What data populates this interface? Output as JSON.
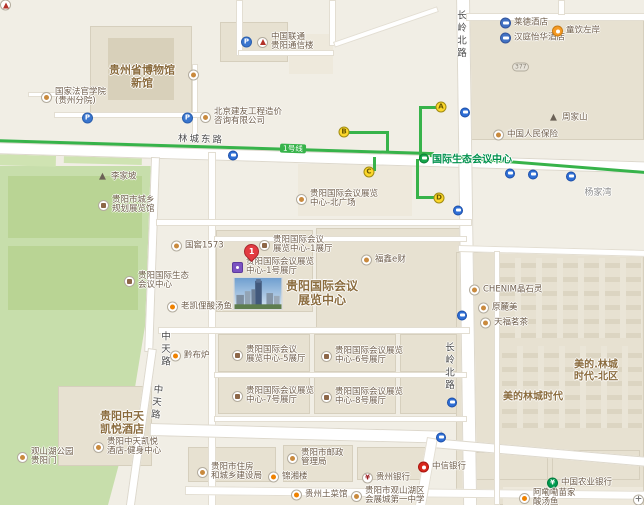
{
  "colors": {
    "metro_line": "#37b34a",
    "park_green": "#c7deab",
    "road_white": "#ffffff",
    "area_label_brown": "#8b6c3e",
    "station_green": "#00914d",
    "exit_yellow": "#fcd72b",
    "pin_red": "#e23b41"
  },
  "transit": {
    "line_label": "1号线",
    "line_label_pos": {
      "x": 280,
      "y": 144
    },
    "station": {
      "name": "国际生态会议中心",
      "x": 419,
      "y": 158
    },
    "exits": [
      {
        "label": "A",
        "x": 441,
        "y": 107
      },
      {
        "label": "B",
        "x": 344,
        "y": 132
      },
      {
        "label": "C",
        "x": 369,
        "y": 172
      },
      {
        "label": "D",
        "x": 439,
        "y": 198
      }
    ],
    "bus_stops": [
      [
        233,
        151
      ],
      [
        465,
        108
      ],
      [
        458,
        206
      ],
      [
        462,
        311
      ],
      [
        452,
        398
      ],
      [
        441,
        433
      ],
      [
        510,
        169
      ],
      [
        533,
        170
      ],
      [
        571,
        172
      ]
    ]
  },
  "road_labels": [
    {
      "text": "林城东路",
      "x": 178,
      "y": 131,
      "vertical": false,
      "rotate": 2
    },
    {
      "text": "长岭北路",
      "x": 453,
      "y": 10,
      "vertical": true,
      "rotate": 0
    },
    {
      "text": "长岭北路",
      "x": 441,
      "y": 342,
      "vertical": true,
      "rotate": 0
    },
    {
      "text": "中天路",
      "x": 157,
      "y": 331,
      "vertical": true,
      "rotate": 0
    },
    {
      "text": "中天路",
      "x": 148,
      "y": 384,
      "vertical": true,
      "rotate": 6
    }
  ],
  "area_labels": [
    {
      "id": "guizhou-museum",
      "lines": [
        "贵州省博物馆",
        "新馆"
      ],
      "x": 142,
      "y": 77,
      "size": 11,
      "muted": false
    },
    {
      "id": "exhibition-center",
      "lines": [
        "贵阳国际会议",
        "展览中心"
      ],
      "x": 322,
      "y": 294,
      "size": 12,
      "muted": false
    },
    {
      "id": "hyatt-hotel",
      "lines": [
        "贵阳中天",
        "凯悦酒店"
      ],
      "x": 122,
      "y": 423,
      "size": 11,
      "muted": false
    },
    {
      "id": "meidi-lincheng-north",
      "lines": [
        "美的.林城",
        "时代-北区"
      ],
      "x": 596,
      "y": 371,
      "size": 10,
      "muted": false
    },
    {
      "id": "meidi-lincheng",
      "lines": [
        "美的林城时代"
      ],
      "x": 533,
      "y": 397,
      "size": 10,
      "muted": false
    },
    {
      "id": "yangjiawan",
      "lines": [
        "杨家湾"
      ],
      "x": 598,
      "y": 193,
      "size": 9,
      "muted": true
    }
  ],
  "pin": {
    "label": "1",
    "x": 252,
    "y": 252
  },
  "pois": [
    {
      "id": "corner-cut",
      "icon": "redb",
      "x": 6,
      "y": 5,
      "lines": []
    },
    {
      "id": "parking-museum-west",
      "icon": "park",
      "x": 88,
      "y": 118,
      "lines": []
    },
    {
      "id": "parking-museum-east",
      "icon": "park",
      "x": 188,
      "y": 118,
      "lines": []
    },
    {
      "id": "law-college",
      "icon": "dot",
      "x": 47,
      "y": 97,
      "lines": [
        "国家法官学院",
        "(贵州分院)"
      ]
    },
    {
      "id": "museum-dot",
      "icon": "dot",
      "x": 194,
      "y": 75,
      "lines": []
    },
    {
      "id": "parking-unicom",
      "icon": "park",
      "x": 247,
      "y": 42,
      "lines": []
    },
    {
      "id": "china-unicom",
      "icon": "redb",
      "x": 263,
      "y": 42,
      "lines": [
        "中国联通",
        "贵阳通信楼"
      ]
    },
    {
      "id": "jianyou-consulting",
      "icon": "dot",
      "x": 206,
      "y": 117,
      "lines": [
        "北京建友工程造价",
        "咨询有限公司"
      ]
    },
    {
      "id": "laide-hotel",
      "icon": "hotel",
      "x": 506,
      "y": 23,
      "lines": [
        "莱德酒店"
      ]
    },
    {
      "id": "hanting-hotel",
      "icon": "hotel",
      "x": 506,
      "y": 38,
      "lines": [
        "汉庭怡华酒店"
      ]
    },
    {
      "id": "zuoan-cafe",
      "icon": "cafe",
      "x": 558,
      "y": 31,
      "lines": [
        "童饮左岸"
      ]
    },
    {
      "id": "badge-377",
      "icon": "badge",
      "x": 518,
      "y": 67,
      "badge": "377",
      "lines": []
    },
    {
      "id": "zhoujiashan",
      "icon": "mtn",
      "x": 554,
      "y": 118,
      "lines": [
        "周家山"
      ]
    },
    {
      "id": "picc",
      "icon": "dot",
      "x": 499,
      "y": 135,
      "lines": [
        "中国人民保险"
      ]
    },
    {
      "id": "lijiapo",
      "icon": "mtn",
      "x": 103,
      "y": 177,
      "lines": [
        "李家坡"
      ]
    },
    {
      "id": "planning-hall",
      "icon": "bldg",
      "x": 104,
      "y": 205,
      "lines": [
        "贵阳市城乡",
        "规划展览馆"
      ]
    },
    {
      "id": "guojiao-1573",
      "icon": "dot",
      "x": 177,
      "y": 246,
      "lines": [
        "国窖1573"
      ]
    },
    {
      "id": "eco-conference-center",
      "icon": "bldg",
      "x": 130,
      "y": 281,
      "lines": [
        "贵阳国际生态",
        "会议中心"
      ]
    },
    {
      "id": "north-plaza",
      "icon": "dot",
      "x": 302,
      "y": 199,
      "lines": [
        "贵阳国际会议展览",
        "中心-北广场"
      ]
    },
    {
      "id": "hall-1",
      "icon": "bldg",
      "x": 265,
      "y": 245,
      "lines": [
        "贵阳国际会议",
        "展览中心-1展厅"
      ]
    },
    {
      "id": "hall-1hao",
      "icon": "purple",
      "x": 238,
      "y": 267,
      "lines": [
        "贵阳国际会议展览",
        "中心-1号展厅"
      ]
    },
    {
      "id": "fuxin-ecai",
      "icon": "dot",
      "x": 367,
      "y": 260,
      "lines": [
        "福鑫e财"
      ]
    },
    {
      "id": "laokaili-fish",
      "icon": "rest",
      "x": 173,
      "y": 307,
      "lines": [
        "老凯俚酸汤鱼"
      ]
    },
    {
      "id": "qianbulu",
      "icon": "rest",
      "x": 176,
      "y": 356,
      "lines": [
        "黔布炉"
      ]
    },
    {
      "id": "hall-5",
      "icon": "bldg",
      "x": 238,
      "y": 355,
      "lines": [
        "贵阳国际会议",
        "展览中心-5展厅"
      ]
    },
    {
      "id": "hall-6",
      "icon": "bldg",
      "x": 327,
      "y": 356,
      "lines": [
        "贵阳国际会议展览",
        "中心-6号展厅"
      ]
    },
    {
      "id": "hall-7",
      "icon": "bldg",
      "x": 238,
      "y": 396,
      "lines": [
        "贵阳国际会议展览",
        "中心-7号展厅"
      ]
    },
    {
      "id": "hall-8",
      "icon": "bldg",
      "x": 327,
      "y": 397,
      "lines": [
        "贵阳国际会议展览",
        "中心-8号展厅"
      ]
    },
    {
      "id": "chenim",
      "icon": "dot",
      "x": 475,
      "y": 290,
      "lines": [
        "CHENIM晶石灵"
      ]
    },
    {
      "id": "yuanlumei",
      "icon": "dot",
      "x": 484,
      "y": 308,
      "lines": [
        "原麓美"
      ]
    },
    {
      "id": "tianfu-tea",
      "icon": "dot",
      "x": 486,
      "y": 323,
      "lines": [
        "天福茗茶"
      ]
    },
    {
      "id": "hyatt-gym",
      "icon": "dot",
      "x": 99,
      "y": 447,
      "lines": [
        "贵阳中天凯悦",
        "酒店-健身中心"
      ]
    },
    {
      "id": "park-gate",
      "icon": "dot",
      "x": 23,
      "y": 457,
      "lines": [
        "观山湖公园",
        "贵阳门"
      ]
    },
    {
      "id": "housing-bureau",
      "icon": "dot",
      "x": 203,
      "y": 472,
      "lines": [
        "贵阳市住房",
        "和城乡建设局"
      ]
    },
    {
      "id": "jinxianglou",
      "icon": "rest",
      "x": 274,
      "y": 477,
      "lines": [
        "锦湘楼"
      ]
    },
    {
      "id": "postal-bureau",
      "icon": "dot",
      "x": 293,
      "y": 458,
      "lines": [
        "贵阳市邮政",
        "管理局"
      ]
    },
    {
      "id": "guizhou-bank",
      "icon": "banky",
      "x": 368,
      "y": 478,
      "lines": [
        "贵州银行"
      ]
    },
    {
      "id": "citic-bank",
      "icon": "bankred",
      "x": 424,
      "y": 467,
      "lines": [
        "中信银行"
      ]
    },
    {
      "id": "abc-bank",
      "icon": "bankgreen",
      "x": 553,
      "y": 483,
      "lines": [
        "中国农业银行"
      ]
    },
    {
      "id": "tucaiguan",
      "icon": "rest",
      "x": 297,
      "y": 495,
      "lines": [
        "贵州土菜馆"
      ]
    },
    {
      "id": "no1-middle-school",
      "icon": "dot",
      "x": 357,
      "y": 496,
      "lines": [
        "贵阳市观山湖区",
        "会展城第一中学"
      ]
    },
    {
      "id": "alele-fish",
      "icon": "rest",
      "x": 525,
      "y": 498,
      "lines": [
        "阿嘞嘞苗家",
        "酸汤鱼"
      ]
    },
    {
      "id": "plus-poi",
      "icon": "plus",
      "x": 639,
      "y": 500,
      "lines": []
    }
  ]
}
